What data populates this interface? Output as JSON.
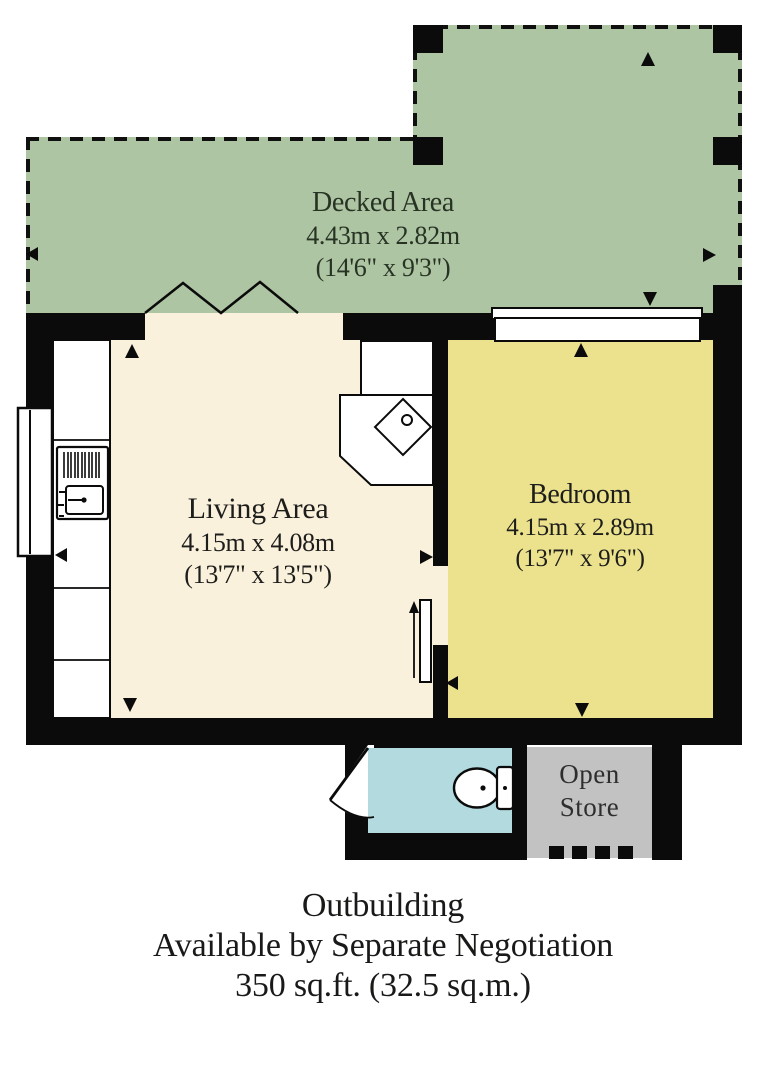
{
  "plan": {
    "decked_area": {
      "title": "Decked Area",
      "dims_metric": "4.43m x 2.82m",
      "dims_imperial": "(14'6\" x 9'3\")"
    },
    "living_area": {
      "title": "Living Area",
      "dims_metric": "4.15m x 4.08m",
      "dims_imperial": "(13'7\" x 13'5\")"
    },
    "bedroom": {
      "title": "Bedroom",
      "dims_metric": "4.15m x 2.89m",
      "dims_imperial": "(13'7\" x 9'6\")"
    },
    "open_store": {
      "line1": "Open",
      "line2": "Store"
    },
    "fixtures": [
      "kitchen-counter",
      "hob",
      "sink",
      "window",
      "bifold-doors",
      "sliding-door",
      "hinged-door",
      "toilet",
      "corner-desk"
    ]
  },
  "caption": {
    "line1": "Outbuilding",
    "line2": "Available by Separate Negotiation",
    "line3": "350 sq.ft. (32.5 sq.m.)"
  },
  "colors": {
    "deck": "#aec5a3",
    "living": "#faf1dc",
    "bedroom": "#ece28d",
    "bath": "#b3dbdf",
    "store": "#c2c2c2",
    "wall": "#0b0b0b",
    "text": "#1d1d1b",
    "deck_text": "#273323"
  }
}
